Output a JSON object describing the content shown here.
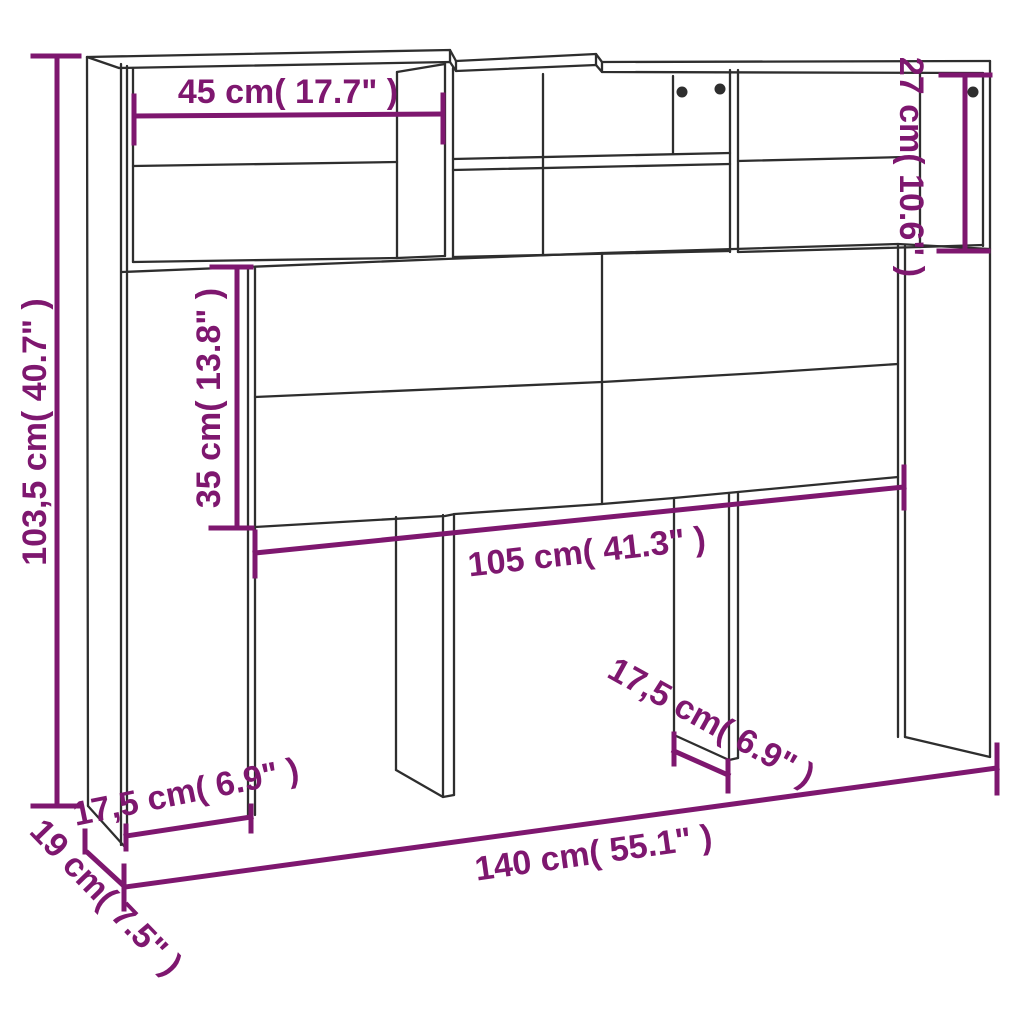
{
  "diagram_type": "furniture-dimension-diagram",
  "product": "headboard-cabinet",
  "colors": {
    "background": "#ffffff",
    "outline": "#2e2e2e",
    "dimension": "#7e176f"
  },
  "labels": {
    "total_height": "103,5 cm( 40.7\" )",
    "compartment_width": "45 cm( 17.7\" )",
    "compartment_height": "27 cm( 10.6\" )",
    "panel_height": "35 cm( 13.8\" )",
    "inner_width": "105 cm( 41.3\" )",
    "left_foot_depth": "17,5 cm( 6.9\" )",
    "right_foot_depth": "17,5 cm( 6.9\" )",
    "total_width": "140 cm( 55.1\" )",
    "total_depth": "19 cm( 7.5\" )"
  }
}
